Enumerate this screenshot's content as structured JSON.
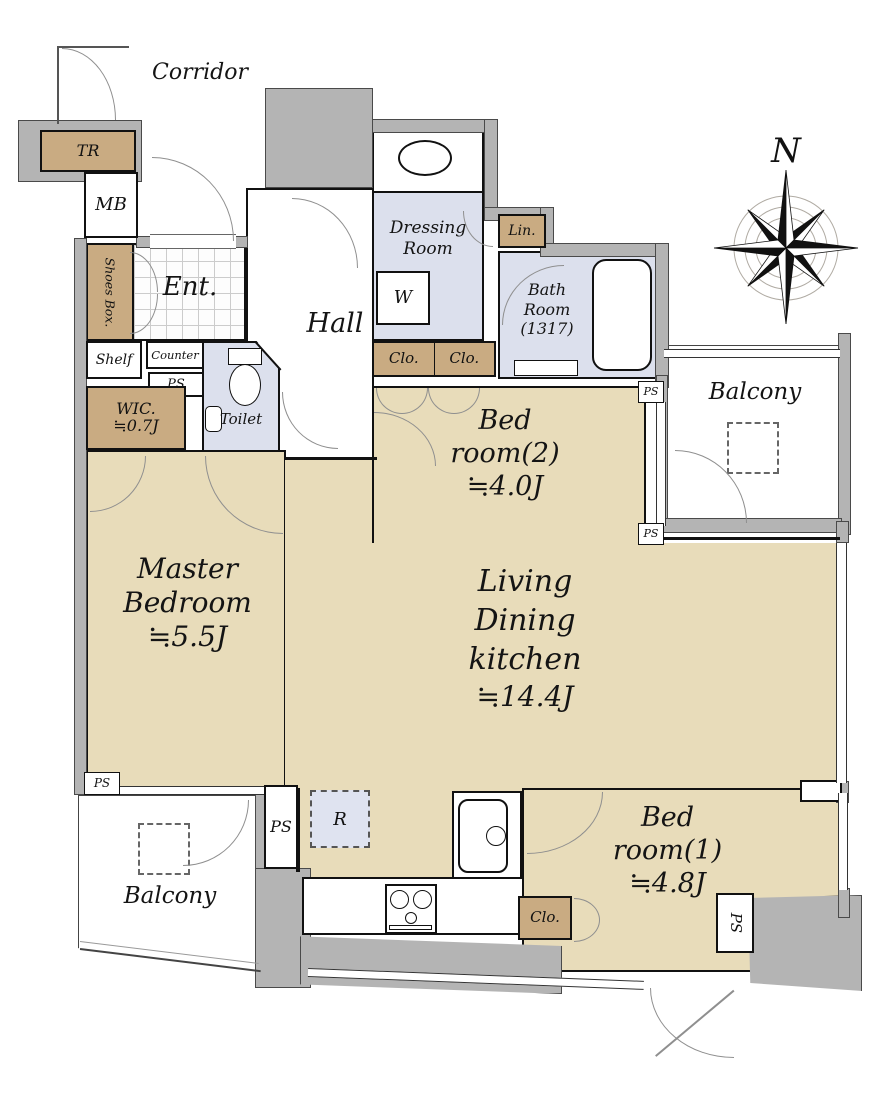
{
  "palette": {
    "room_fill": "#e8dcba",
    "closet_fill": "#c9ab82",
    "wet_fill": "#dce0ed",
    "wall_gray": "#b4b4b4",
    "line": "#111111"
  },
  "compass": {
    "north_label": "N"
  },
  "labels": {
    "corridor": "Corridor",
    "tr": "TR",
    "mb": "MB",
    "shoes_box": "Shoes Box.",
    "ent": "Ent.",
    "hall": "Hall",
    "dressing_line1": "Dressing",
    "dressing_line2": "Room",
    "washer": "W",
    "lin": "Lin.",
    "bath_line1": "Bath",
    "bath_line2": "Room",
    "bath_line3": "(1317)",
    "clo": "Clo.",
    "ps": "PS",
    "shelf": "Shelf",
    "counter": "Counter",
    "toilet": "Toilet",
    "wic_line1": "WIC.",
    "wic_line2": "≒0.7J",
    "balcony": "Balcony",
    "refrigerator": "R"
  },
  "rooms": {
    "master": {
      "line1": "Master",
      "line2": "Bedroom",
      "size": "≒5.5J"
    },
    "bedroom2": {
      "line1": "Bed",
      "line2": "room(2)",
      "size": "≒4.0J"
    },
    "bedroom1": {
      "line1": "Bed",
      "line2": "room(1)",
      "size": "≒4.8J"
    },
    "ldk": {
      "line1": "Living",
      "line2": "Dining",
      "line3": "kitchen",
      "size": "≒14.4J"
    }
  }
}
